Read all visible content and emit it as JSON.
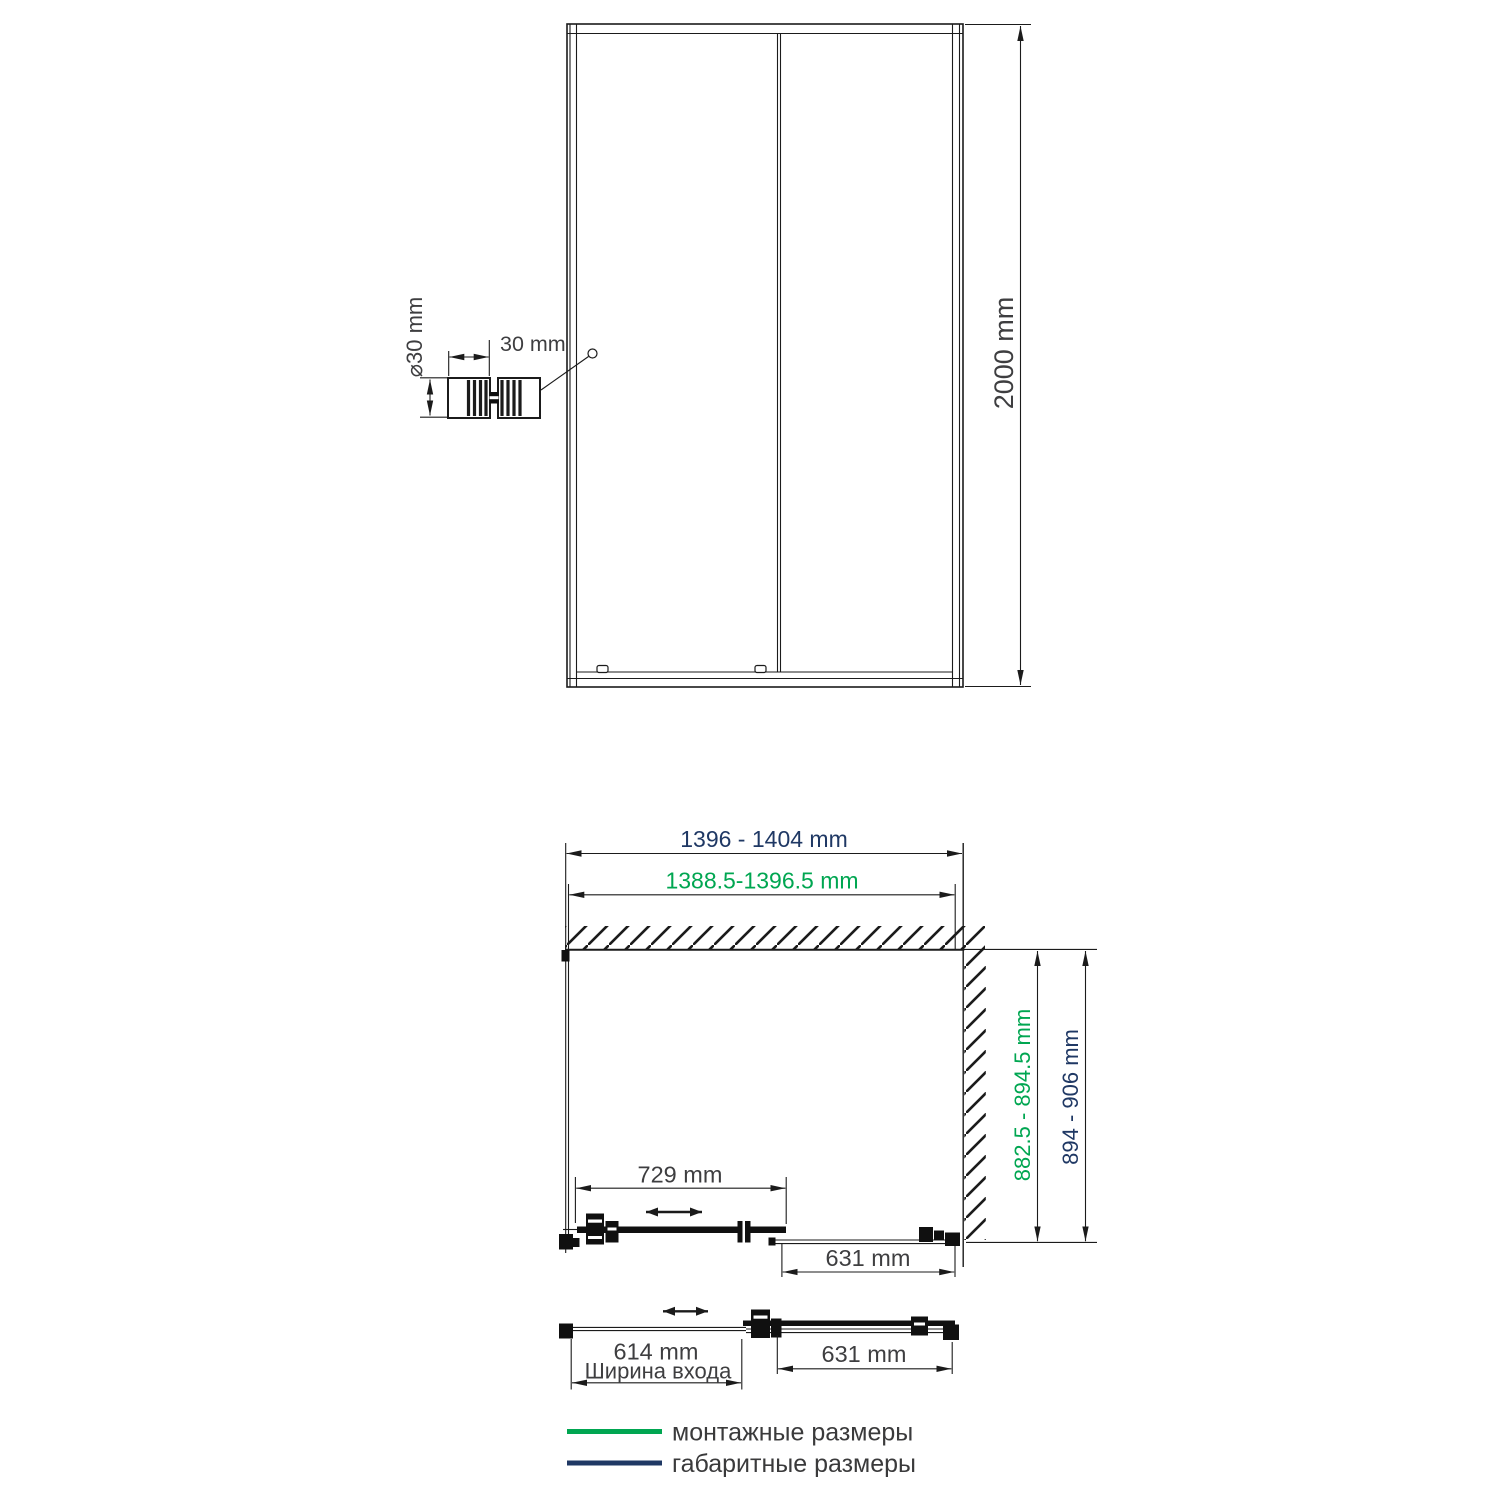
{
  "colors": {
    "mounting_green": "#00a651",
    "overall_navy": "#1f3864",
    "drawing_line": "#1b1b1b",
    "label_gray": "#3e3e40"
  },
  "front_view": {
    "height": "2000 mm",
    "handle_diameter": "⌀30 mm",
    "handle_width": "30 mm"
  },
  "plan_view": {
    "overall_width": "1396 - 1404 mm",
    "mounting_width": "1388.5-1396.5 mm",
    "mounting_depth": "882.5 - 894.5 mm",
    "overall_depth": "894 - 906 mm",
    "slide_panel_width": "729 mm",
    "fixed_panel_width": "631 mm"
  },
  "open_view": {
    "entry_width": "614 mm",
    "entry_width_caption": "Ширина входа",
    "fixed_panel_width": "631 mm"
  },
  "legend": {
    "mounting": "монтажные размеры",
    "overall": "габаритные размеры"
  }
}
